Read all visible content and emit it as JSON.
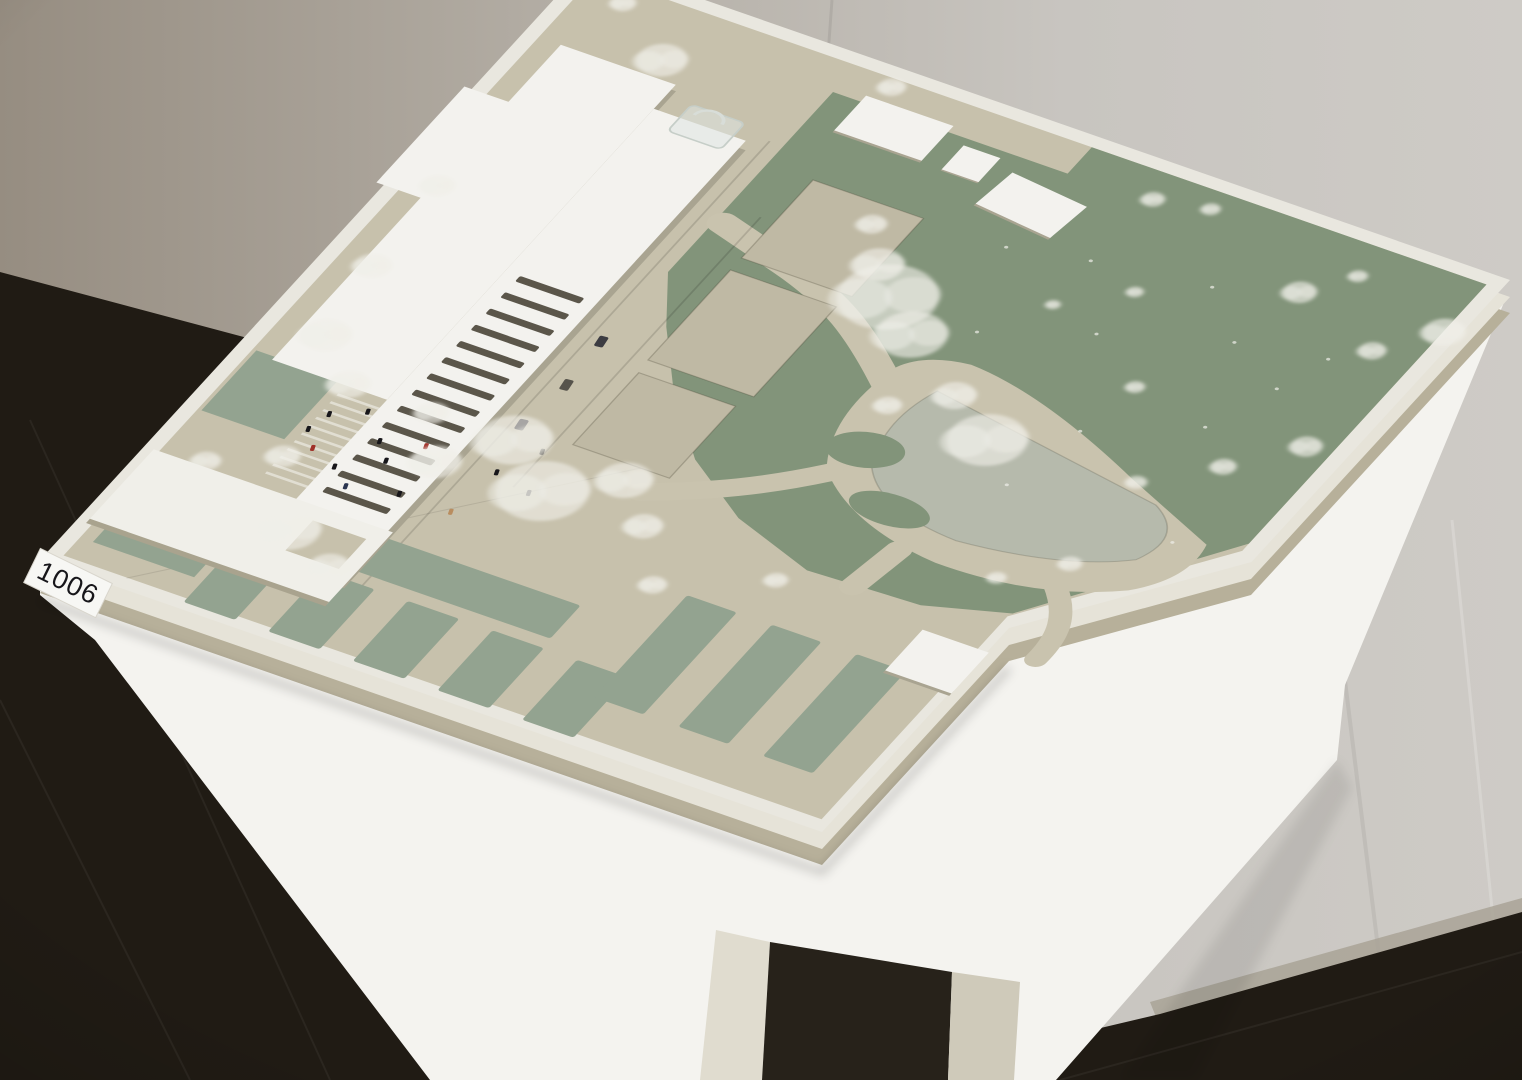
{
  "scene": {
    "description": "Architectural competition site model (maquette) on a white pedestal table in a gallery corner with grey wall and dark tile floor",
    "entry_label": "1006"
  },
  "label_card": {
    "text": "1006"
  },
  "colors": {
    "wall_light": "#cdc9c4",
    "wall_mid": "#b7b2ab",
    "wall_dark": "#8e8679",
    "floor": "#201b14",
    "table": "#f4f3ef",
    "pedestal": "#e0dccf",
    "pedestal_2": "#cfcaba",
    "pedestal_gap": "#27221a",
    "board_rim": "#e9e7df",
    "board_edge": "#e6e3d8",
    "board_edge_dark": "#b7b09a",
    "base_beige": "#c7c1ac",
    "path_beige": "#c9c3ae",
    "court_beige": "#bfb9a4",
    "field_green": "#82947a",
    "comb_green": "#93a390",
    "pond": "#b6baac",
    "building_white": "#f3f2ee",
    "building_face": "#a9a491",
    "slit_dark": "#5b564a",
    "canopy_white": "#f0efe9",
    "tree_white": "#f0efe9",
    "sticker_bg": "#f7f7f4",
    "ink": "#17161a"
  },
  "model": {
    "trees": [
      [
        135,
        95,
        24
      ],
      [
        60,
        40,
        12
      ],
      [
        345,
        28,
        13
      ],
      [
        645,
        55,
        11
      ],
      [
        700,
        42,
        9
      ],
      [
        985,
        95,
        20
      ],
      [
        940,
        150,
        13
      ],
      [
        872,
        62,
        9
      ],
      [
        500,
        295,
        48
      ],
      [
        548,
        332,
        34
      ],
      [
        468,
        258,
        24
      ],
      [
        432,
        210,
        14
      ],
      [
        836,
        108,
        16
      ],
      [
        958,
        300,
        15
      ],
      [
        905,
        362,
        12
      ],
      [
        845,
        420,
        10
      ],
      [
        772,
        300,
        9
      ],
      [
        700,
        180,
        8
      ],
      [
        642,
        232,
        7
      ],
      [
        690,
        432,
        38
      ],
      [
        630,
        390,
        20
      ],
      [
        582,
        432,
        13
      ],
      [
        45,
        352,
        16
      ],
      [
        52,
        482,
        18
      ],
      [
        66,
        590,
        24
      ],
      [
        122,
        642,
        20
      ],
      [
        300,
        640,
        36
      ],
      [
        362,
        692,
        44
      ],
      [
        422,
        642,
        26
      ],
      [
        472,
        692,
        18
      ],
      [
        252,
        702,
        24
      ],
      [
        212,
        642,
        16
      ],
      [
        182,
        852,
        30
      ],
      [
        244,
        882,
        20
      ],
      [
        122,
        762,
        16
      ],
      [
        62,
        802,
        14
      ],
      [
        524,
        762,
        13
      ],
      [
        622,
        702,
        11
      ],
      [
        852,
        552,
        11
      ],
      [
        802,
        602,
        9
      ]
    ],
    "specks": [
      [
        760,
        140
      ],
      [
        820,
        200
      ],
      [
        890,
        240
      ],
      [
        700,
        250
      ],
      [
        640,
        160
      ],
      [
        760,
        380
      ],
      [
        920,
        480
      ],
      [
        600,
        300
      ],
      [
        860,
        320
      ],
      [
        740,
        480
      ],
      [
        560,
        180
      ],
      [
        910,
        180
      ]
    ],
    "figures": [
      [
        128,
        688,
        "#17161a"
      ],
      [
        158,
        668,
        "#17161a"
      ],
      [
        190,
        700,
        "#17161a"
      ],
      [
        140,
        738,
        "#a03028"
      ],
      [
        172,
        752,
        "#17161a"
      ],
      [
        210,
        722,
        "#17161a"
      ],
      [
        232,
        686,
        "#a03028"
      ],
      [
        196,
        772,
        "#2a3550"
      ],
      [
        246,
        758,
        "#17161a"
      ],
      [
        122,
        716,
        "#17161a"
      ],
      [
        310,
        688,
        "#17161a"
      ],
      [
        332,
        642,
        "#46443e"
      ],
      [
        352,
        700,
        "#17161a"
      ],
      [
        302,
        758,
        "#b98d5f"
      ]
    ],
    "cars": [
      [
        292,
        470,
        "#3c3c42"
      ],
      [
        296,
        540,
        "#56534b"
      ],
      [
        289,
        610,
        "#2f2d34"
      ]
    ],
    "roof_slits": {
      "count": 14,
      "u": 181,
      "width": 70,
      "v_start": 430,
      "step": 27,
      "height": 9
    },
    "forecourt_stripes": {
      "count": 11,
      "u_start": 120,
      "u_end": 260,
      "v_start": 660,
      "step": 13
    },
    "allotment_groups": [
      {
        "band": [
          150,
          820,
          330,
          55
        ],
        "fingers": {
          "count": 5,
          "u_start": 150,
          "step": 92,
          "width": 56,
          "v": 890,
          "height": 100
        }
      },
      {
        "band": null,
        "fingers": {
          "count": 3,
          "u_start": 560,
          "step": 92,
          "width": 54,
          "v": 760,
          "height": 170
        }
      }
    ]
  }
}
